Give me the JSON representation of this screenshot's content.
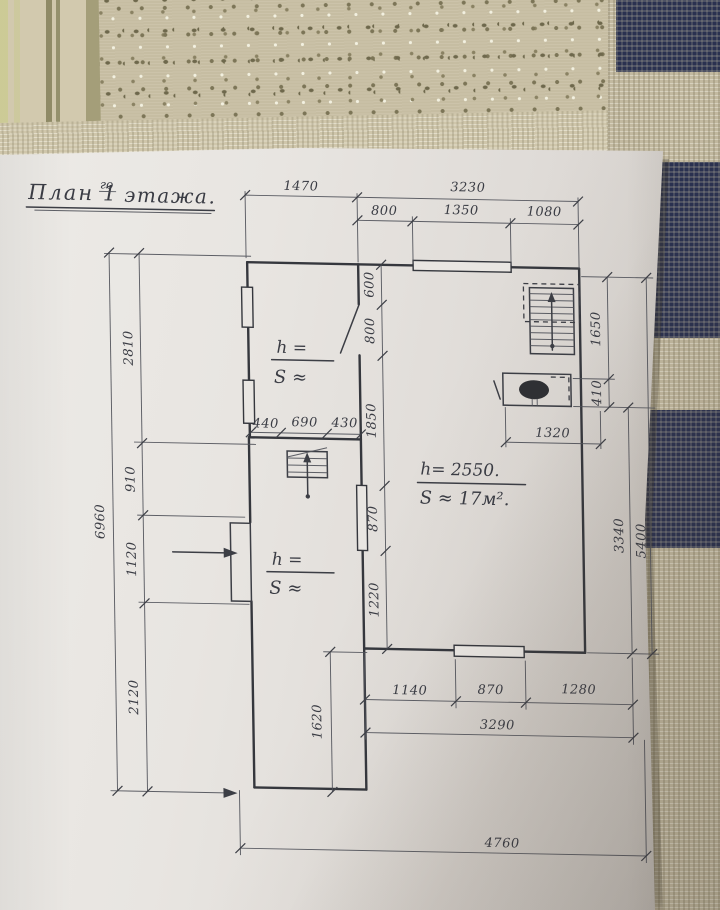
{
  "plan": {
    "title": {
      "prefix": "План 1",
      "sup": "го",
      "suffix": "этажа."
    },
    "dims": {
      "top_row1": [
        "1470",
        "3230"
      ],
      "top_row2": [
        "800",
        "1350",
        "1080"
      ],
      "left_inner": [
        "2810",
        "910",
        "1120",
        "2120"
      ],
      "left_total": "6960",
      "mid_col": [
        "600",
        "800",
        "1850",
        "870",
        "1220"
      ],
      "mid_row": [
        "440",
        "690",
        "430"
      ],
      "right_col": [
        "1650",
        "410",
        "3340",
        "5400"
      ],
      "appliance_width": "1320",
      "bottom_row1": [
        "1140",
        "870",
        "1280"
      ],
      "bottom_row2": "3290",
      "porch_height": "1620",
      "bottom_total": "4760"
    },
    "rooms": {
      "main": {
        "height": "h= 2550.",
        "area": "S ≈ 17м²."
      },
      "upper": {
        "height": "h =",
        "area": "S ≈"
      },
      "lower": {
        "height": "h =",
        "area": "S ≈"
      }
    },
    "colors": {
      "pencil": "#3c3e45",
      "paper": "#e8e5e1",
      "cloth_navy": "#2a3150",
      "cloth_beige": "#c6bda2",
      "cloth_olive": "#8f8a66"
    }
  }
}
